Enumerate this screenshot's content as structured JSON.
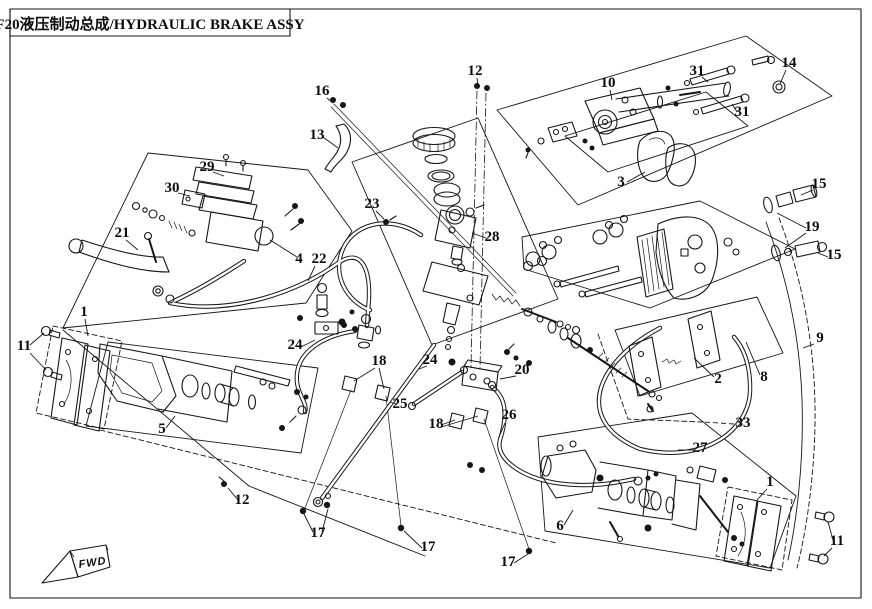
{
  "title": "F20液压制动总成/HYDRAULIC BRAKE ASSY",
  "direction_label": "FWD",
  "colors": {
    "ink": "#161616",
    "paper": "#ffffff"
  },
  "callouts": [
    {
      "n": "16",
      "x": 322,
      "y": 95,
      "leaders": [
        [
          327,
          98,
          333,
          103
        ]
      ]
    },
    {
      "n": "13",
      "x": 317,
      "y": 139,
      "leaders": [
        [
          323,
          137,
          338,
          148
        ]
      ]
    },
    {
      "n": "12",
      "x": 475,
      "y": 75,
      "leaders": [
        [
          477,
          78,
          478,
          85
        ]
      ]
    },
    {
      "n": "10",
      "x": 608,
      "y": 87,
      "leaders": [
        [
          610,
          90,
          612,
          100
        ]
      ]
    },
    {
      "n": "31",
      "x": 697,
      "y": 75,
      "leaders": [
        [
          702,
          77,
          708,
          82
        ]
      ]
    },
    {
      "n": "14",
      "x": 789,
      "y": 67,
      "leaders": [
        [
          786,
          70,
          780,
          84
        ]
      ]
    },
    {
      "n": "31",
      "x": 742,
      "y": 116,
      "leaders": [
        [
          737,
          112,
          732,
          104
        ]
      ]
    },
    {
      "n": "3",
      "x": 621,
      "y": 186,
      "leaders": [
        [
          627,
          182,
          645,
          172
        ]
      ]
    },
    {
      "n": "29",
      "x": 207,
      "y": 171,
      "leaders": [
        [
          213,
          172,
          224,
          176
        ]
      ]
    },
    {
      "n": "30",
      "x": 172,
      "y": 192,
      "leaders": [
        [
          178,
          193,
          190,
          196
        ]
      ]
    },
    {
      "n": "21",
      "x": 122,
      "y": 237,
      "leaders": [
        [
          126,
          240,
          138,
          250
        ]
      ]
    },
    {
      "n": "4",
      "x": 299,
      "y": 263,
      "leaders": [
        [
          297,
          257,
          270,
          240
        ]
      ]
    },
    {
      "n": "22",
      "x": 319,
      "y": 263,
      "leaders": [
        [
          315,
          266,
          308,
          281
        ]
      ]
    },
    {
      "n": "23",
      "x": 372,
      "y": 208,
      "leaders": [
        [
          376,
          211,
          384,
          219
        ]
      ]
    },
    {
      "n": "28",
      "x": 492,
      "y": 241,
      "leaders": [
        [
          486,
          238,
          472,
          233
        ]
      ]
    },
    {
      "n": "15",
      "x": 819,
      "y": 188,
      "leaders": [
        [
          813,
          190,
          801,
          195
        ]
      ]
    },
    {
      "n": "19",
      "x": 812,
      "y": 231,
      "leaders": [
        [
          806,
          228,
          777,
          213
        ],
        [
          806,
          233,
          785,
          248
        ]
      ]
    },
    {
      "n": "15",
      "x": 834,
      "y": 259,
      "leaders": [
        [
          828,
          257,
          818,
          253
        ]
      ]
    },
    {
      "n": "9",
      "x": 820,
      "y": 342,
      "leaders": [
        [
          814,
          344,
          803,
          348
        ]
      ]
    },
    {
      "n": "2",
      "x": 718,
      "y": 383,
      "leaders": [
        [
          714,
          377,
          694,
          358
        ]
      ]
    },
    {
      "n": "8",
      "x": 764,
      "y": 381,
      "leaders": [
        [
          760,
          375,
          746,
          342
        ]
      ]
    },
    {
      "n": "11",
      "x": 24,
      "y": 350,
      "leaders": [
        [
          30,
          345,
          44,
          333
        ],
        [
          30,
          353,
          46,
          370
        ]
      ]
    },
    {
      "n": "1",
      "x": 84,
      "y": 316,
      "leaders": [
        [
          85,
          319,
          88,
          336
        ]
      ]
    },
    {
      "n": "5",
      "x": 162,
      "y": 433,
      "leaders": [
        [
          166,
          428,
          175,
          416
        ]
      ]
    },
    {
      "n": "24",
      "x": 295,
      "y": 349,
      "leaders": [
        [
          301,
          347,
          315,
          340
        ]
      ]
    },
    {
      "n": "18",
      "x": 379,
      "y": 365,
      "leaders": [
        [
          375,
          368,
          354,
          381
        ],
        [
          379,
          368,
          384,
          389
        ]
      ]
    },
    {
      "n": "24",
      "x": 430,
      "y": 364,
      "leaders": [
        [
          427,
          366,
          419,
          369
        ]
      ]
    },
    {
      "n": "25",
      "x": 400,
      "y": 408,
      "leaders": [
        [
          396,
          404,
          390,
          402
        ]
      ]
    },
    {
      "n": "18",
      "x": 436,
      "y": 428,
      "leaders": [
        [
          441,
          425,
          455,
          420
        ],
        [
          441,
          427,
          478,
          416
        ]
      ]
    },
    {
      "n": "20",
      "x": 522,
      "y": 374,
      "leaders": [
        [
          516,
          376,
          500,
          379
        ]
      ]
    },
    {
      "n": "26",
      "x": 509,
      "y": 419,
      "leaders": [
        [
          505,
          423,
          499,
          437
        ]
      ]
    },
    {
      "n": "33",
      "x": 743,
      "y": 427,
      "dash": true,
      "leaders": [
        [
          734,
          424,
          704,
          422
        ]
      ]
    },
    {
      "n": "27",
      "x": 700,
      "y": 452,
      "leaders": [
        [
          694,
          450,
          678,
          450
        ]
      ]
    },
    {
      "n": "6",
      "x": 560,
      "y": 530,
      "leaders": [
        [
          564,
          525,
          573,
          510
        ]
      ]
    },
    {
      "n": "1",
      "x": 770,
      "y": 486,
      "leaders": [
        [
          767,
          489,
          757,
          500
        ]
      ]
    },
    {
      "n": "11",
      "x": 837,
      "y": 545,
      "leaders": [
        [
          833,
          540,
          828,
          522
        ],
        [
          832,
          548,
          824,
          556
        ]
      ]
    },
    {
      "n": "12",
      "x": 242,
      "y": 504,
      "leaders": [
        [
          238,
          500,
          228,
          488
        ]
      ]
    },
    {
      "n": "17",
      "x": 318,
      "y": 537,
      "leaders": [
        [
          313,
          532,
          304,
          514
        ],
        [
          322,
          532,
          328,
          509
        ]
      ]
    },
    {
      "n": "17",
      "x": 428,
      "y": 551,
      "leaders": [
        [
          422,
          548,
          404,
          531
        ]
      ]
    },
    {
      "n": "17",
      "x": 508,
      "y": 566,
      "leaders": [
        [
          514,
          563,
          528,
          554
        ]
      ]
    }
  ]
}
